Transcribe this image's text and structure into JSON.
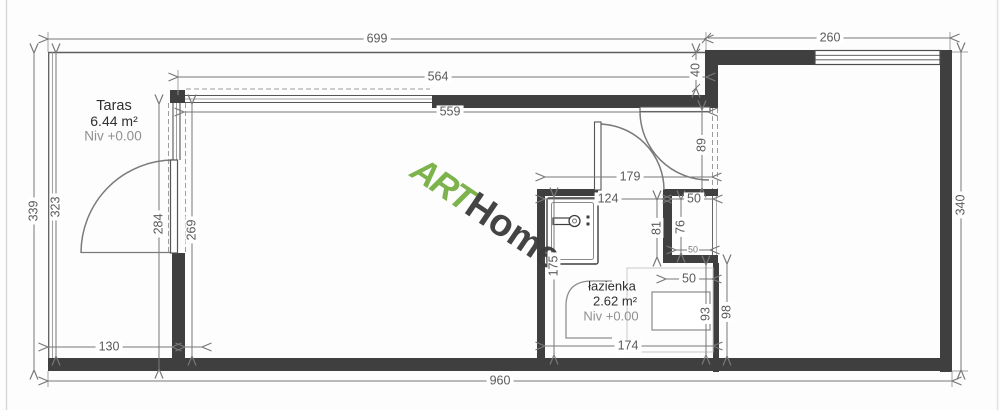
{
  "watermark": {
    "art": "ART",
    "home": "Home"
  },
  "rooms": {
    "taras": {
      "name": "Taras",
      "area": "6.44 m²",
      "level": "Niv +0.00"
    },
    "lazienka": {
      "name": "łazienka",
      "area": "2.62 m²",
      "level": "Niv +0.00"
    }
  },
  "dimensions": {
    "top_total": "699",
    "top_right": "260",
    "top_inner_upper": "564",
    "top_inner_lower": "559",
    "facade_offset": "40",
    "left_total": "339",
    "left_inner": "323",
    "terrace_height": "284",
    "room_height_left": "269",
    "terrace_bottom_width": "130",
    "bottom_total": "960",
    "right_total": "340",
    "entry_opening": "89",
    "bath_top_width": "179",
    "bath_inner_width": "124",
    "niche_width": "50",
    "bath_upper_height": "81",
    "niche_height": "76",
    "niche_bottom_width": "50",
    "step_width": "50",
    "shower_height": "93",
    "step_height": "98",
    "bath_inner_height": "175",
    "bath_bottom_width": "174"
  },
  "colors": {
    "wall": "#3f3f3f",
    "line": "#787878",
    "dim_text": "#5a5a5a",
    "logo_green": "#76b043",
    "logo_dark": "#3b3b3b"
  }
}
